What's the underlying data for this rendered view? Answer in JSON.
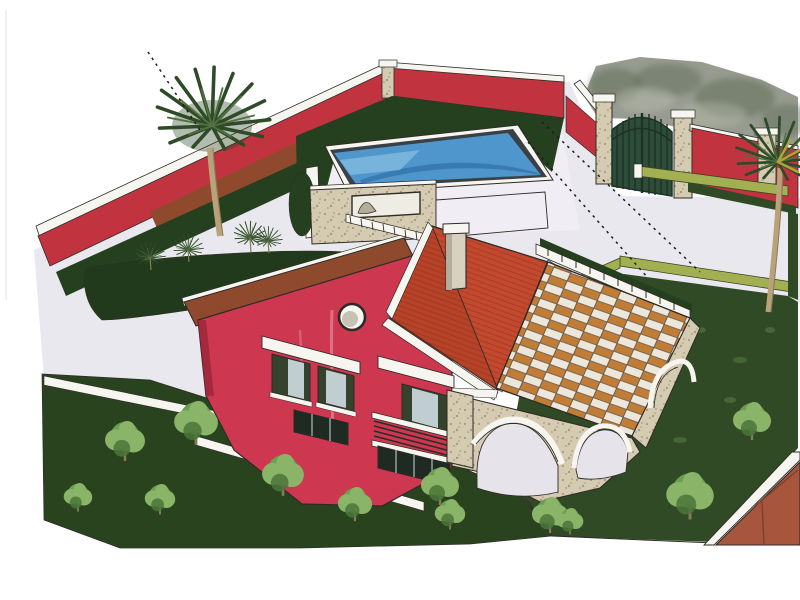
{
  "page": {
    "width_px": 800,
    "height_px": 600,
    "background": "#ffffff"
  },
  "scene": {
    "kind": "architectural-3d-rendering",
    "subject": "Aerial perspective rendering of a walled villa: red perimeter wall, swimming pool, entrance gate, crimson two-story house with tiled roof and chimney, checkered pergola terrace over a stone arcade, palm trees, garden trees and paved driveway",
    "visible_text": [],
    "elements": [
      "perimeter-wall",
      "garden-hedge",
      "swimming-pool",
      "pool-deck",
      "pool-front-wall",
      "wall-niche",
      "entrance-gate",
      "gate-pillars",
      "driveway",
      "parking-pad",
      "curbs",
      "villa-left-wing",
      "villa-windows",
      "balcony",
      "round-window",
      "main-roof",
      "chimney",
      "roof-walkway",
      "pergola-checker-roof",
      "terrace-railing",
      "stone-arcade",
      "arches",
      "left-palm-tree",
      "right-palm-tree",
      "small-palms",
      "garden-trees",
      "left-slope-garden",
      "lawn-island",
      "right-lawn",
      "outside-trees",
      "boundary-dashed-lines",
      "corner-roof-wedge"
    ]
  },
  "palette": {
    "page_bg": "#ffffff",
    "ink": "#2e2b26",
    "dash": "#1c1c1c",
    "scanline": "#ccd4da",
    "paving": "#e9e8ee",
    "deck": "#f0eef4",
    "trim_white": "#f7f5ef",
    "wall_red": "#c23340",
    "wall_brown": "#8f4a2e",
    "house_red": "#ce3750",
    "house_red_shade": "#9c2438",
    "roof_red": "#c2492e",
    "roof_red_dark": "#a83a22",
    "roof_tile_line": "#8f2f1c",
    "chimney": "#d8d1c0",
    "chimney_shade": "#b4ad9b",
    "shutter_green": "#35422e",
    "glass_dark": "#1f2b22",
    "glass_light": "#ccd9df",
    "rail_dark": "#2c2c28",
    "hedge_dark": "#25401e",
    "island_dark": "#223a1c",
    "slope_green": "#2a431f",
    "lawn_green": "#2f4a25",
    "lawn_speckle": "#6f9a55",
    "tree_light": "#8ab468",
    "tree_mid": "#6a9e50",
    "tree_dark": "#4a763a",
    "palm_green": "#2f4a28",
    "palm_light": "#50713f",
    "palm_trunk": "#b9a179",
    "trunk_edge": "#8a7a58",
    "palm_yellow": "#b3a339",
    "pool_rim": "#3a4146",
    "pool_water": "#4f96cc",
    "pool_water_light": "#8fc3e4",
    "pool_water_dark": "#2f6da8",
    "stone": "#d5cbb2",
    "stone_dot": "#a89c74",
    "checker_light": "#ece7da",
    "checker_orange": "#c17c35",
    "checker_line": "#5a544c",
    "arch_interior": "#e7e3ea",
    "gate_green": "#2e4d38",
    "gate_dark": "#1c3226",
    "curb_green": "#a3b052",
    "curb_edge": "#3c4226",
    "mottle_gray": "#979b90",
    "mottle_dark": "#5c6852",
    "mottle_light": "#b8bcae",
    "wedge_brown": "#a8553d",
    "wedge_dark": "#7e3f2c",
    "pink_streak": "#eeb9c6",
    "niche_fill": "#efece4"
  }
}
